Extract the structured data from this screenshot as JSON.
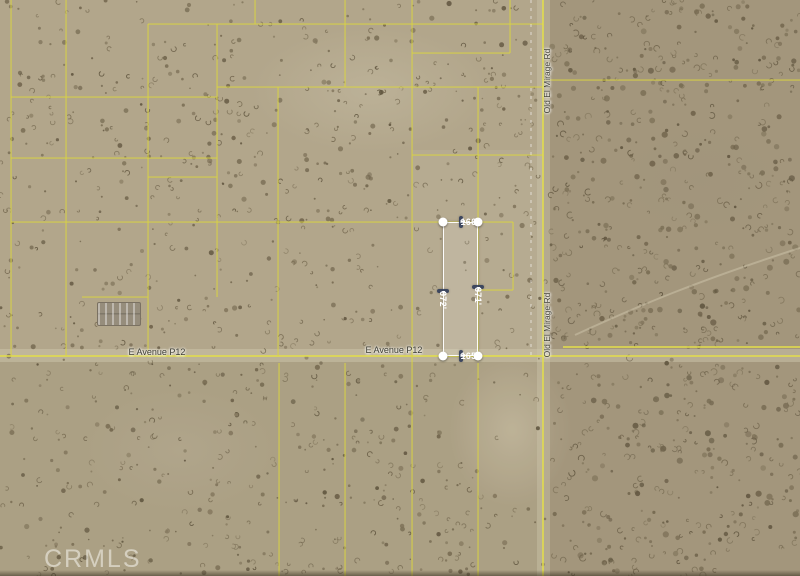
{
  "image": {
    "width": 800,
    "height": 576
  },
  "watermark": {
    "text": "CRMLS"
  },
  "ui": {
    "arrow_left": "◄",
    "arrow_right": "►"
  },
  "roads": {
    "e_avenue": {
      "name": "E Avenue P12",
      "labels": [
        {
          "x": 157,
          "y": 352
        },
        {
          "x": 394,
          "y": 350
        }
      ]
    },
    "old_el_mirage": {
      "name": "Old El Mirage Rd",
      "labels": [
        {
          "x": 547,
          "y": 81
        },
        {
          "x": 547,
          "y": 325
        }
      ]
    }
  },
  "parcel": {
    "rect": {
      "x": 443,
      "y": 222,
      "width": 35,
      "height": 134
    },
    "dim_top": "166'",
    "dim_bottom": "165'",
    "dim_left": "672'",
    "dim_right": "671'"
  },
  "colors": {
    "terrain_base": "#b2a68b",
    "terrain_east": "#a4997d",
    "speckle": "#6b604a",
    "parcel_line_yellow": "#d9d442",
    "road_line_yellow": "#e3de4a",
    "dashed_section_line": "rgba(255,255,255,0.6)",
    "dim_label_bg": "#2b3857",
    "dim_label_text": "#ffffff",
    "road_label_text": "#3c3c32",
    "watermark_color": "rgba(252,252,246,0.52)"
  },
  "lines": {
    "horizontal": [
      {
        "y": 24,
        "x1": 148,
        "x2": 543
      },
      {
        "y": 53,
        "x1": 412,
        "x2": 510
      },
      {
        "y": 80,
        "x1": 543,
        "x2": 800
      },
      {
        "y": 87,
        "x1": 217,
        "x2": 543
      },
      {
        "y": 97,
        "x1": 11,
        "x2": 217
      },
      {
        "y": 155,
        "x1": 412,
        "x2": 543
      },
      {
        "y": 158,
        "x1": 11,
        "x2": 217
      },
      {
        "y": 177,
        "x1": 148,
        "x2": 217
      },
      {
        "y": 222,
        "x1": 11,
        "x2": 513
      },
      {
        "y": 290,
        "x1": 478,
        "x2": 513
      },
      {
        "y": 297,
        "x1": 82,
        "x2": 148
      },
      {
        "y": 347,
        "x1": 563,
        "x2": 800,
        "road": true
      },
      {
        "y": 356,
        "x1": 0,
        "x2": 800,
        "road": true
      }
    ],
    "vertical": [
      {
        "x": 11,
        "y1": 0,
        "y2": 356
      },
      {
        "x": 66,
        "y1": 0,
        "y2": 356
      },
      {
        "x": 148,
        "y1": 24,
        "y2": 356
      },
      {
        "x": 217,
        "y1": 24,
        "y2": 297
      },
      {
        "x": 255,
        "y1": 0,
        "y2": 24
      },
      {
        "x": 278,
        "y1": 87,
        "y2": 356
      },
      {
        "x": 279,
        "y1": 363,
        "y2": 576
      },
      {
        "x": 345,
        "y1": 0,
        "y2": 87
      },
      {
        "x": 345,
        "y1": 363,
        "y2": 576
      },
      {
        "x": 412,
        "y1": 0,
        "y2": 576
      },
      {
        "x": 478,
        "y1": 87,
        "y2": 222
      },
      {
        "x": 478,
        "y1": 222,
        "y2": 356
      },
      {
        "x": 478,
        "y1": 363,
        "y2": 576
      },
      {
        "x": 510,
        "y1": 0,
        "y2": 53
      },
      {
        "x": 513,
        "y1": 222,
        "y2": 290
      },
      {
        "x": 543,
        "y1": 0,
        "y2": 576,
        "road": true
      }
    ],
    "dashed_vertical": {
      "x": 531,
      "y1": 0,
      "y2": 356
    }
  }
}
